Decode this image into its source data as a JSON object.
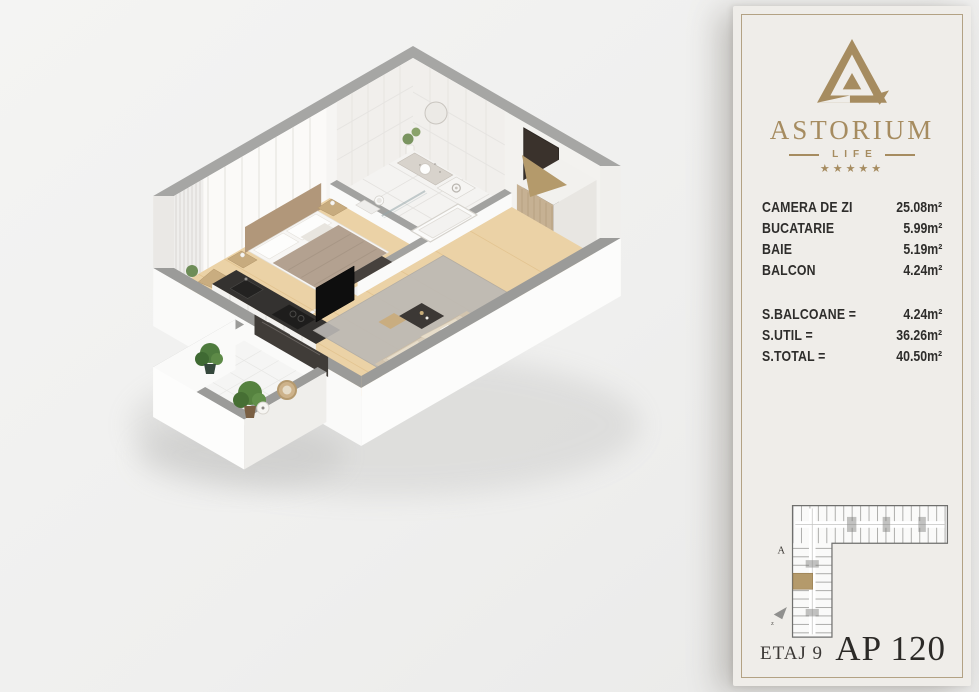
{
  "brand": {
    "name": "ASTORIUM",
    "subtitle": "LIFE",
    "stars": "★★★★★"
  },
  "areas": {
    "rooms": [
      {
        "label": "CAMERA DE ZI",
        "value": "25.08m²"
      },
      {
        "label": "BUCATARIE",
        "value": "5.99m²"
      },
      {
        "label": "BAIE",
        "value": "5.19m²"
      },
      {
        "label": "BALCON",
        "value": "4.24m²"
      }
    ],
    "totals": [
      {
        "label": "S.BALCOANE =",
        "value": "4.24m²"
      },
      {
        "label": "S.UTIL =",
        "value": "36.26m²"
      },
      {
        "label": "S.TOTAL =",
        "value": "40.50m²"
      }
    ]
  },
  "map": {
    "section_letter": "A",
    "compass_letter": "z"
  },
  "footer": {
    "floor": "ETAJ 9",
    "apartment": "AP 120"
  },
  "colors": {
    "gold": "#a68c60",
    "arrow_gold": "#b49a6b",
    "text_dark": "#2e2d2b",
    "panel_bg": "#efede9",
    "panel_border": "#b3a284",
    "wall_gray": "#a6a6a4",
    "wood_floor": "#ebd2a6",
    "rug_gray": "#bcb9b5"
  }
}
